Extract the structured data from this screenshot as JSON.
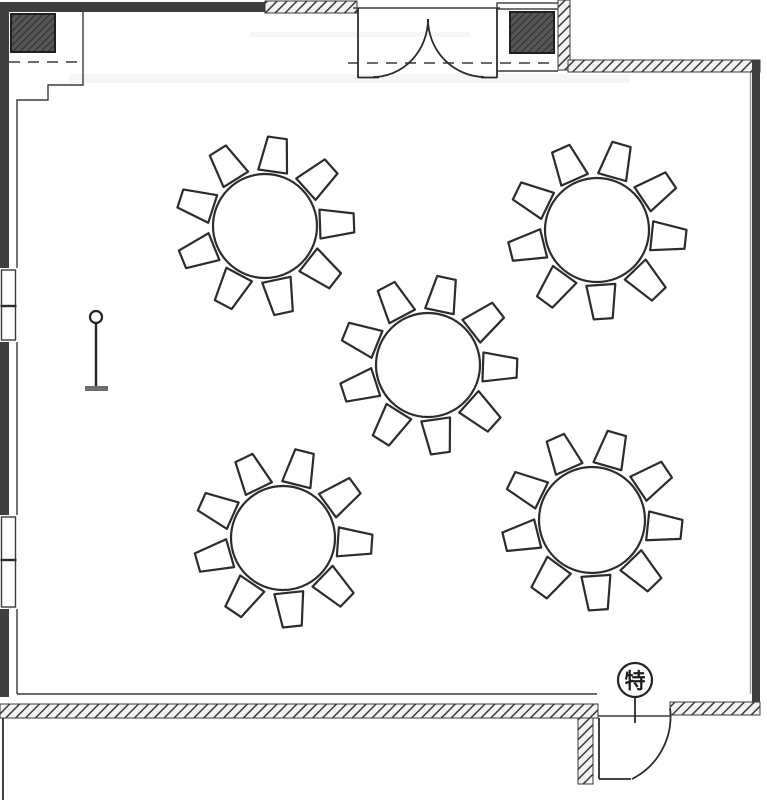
{
  "plan": {
    "type": "banquet-room-floor-plan",
    "colors": {
      "line": "#2c2c2c",
      "wall_fill": "#3e3e3e",
      "hatch_line": "#3a3a3a",
      "column_fill": "#565656",
      "stand_base": "#6e6e6e",
      "paper": "#ffffff"
    },
    "tag": {
      "label": "特"
    },
    "tables": [
      {
        "name": "banquet-table-1",
        "cx": 265,
        "cy": 226,
        "r": 52,
        "chairs": 9,
        "phase": 358
      },
      {
        "name": "banquet-table-2",
        "cx": 597,
        "cy": 230,
        "r": 52,
        "chairs": 9,
        "phase": 6
      },
      {
        "name": "banquet-table-3",
        "cx": 428,
        "cy": 365,
        "r": 52,
        "chairs": 9,
        "phase": 2
      },
      {
        "name": "banquet-table-4",
        "cx": 283,
        "cy": 538,
        "r": 52,
        "chairs": 9,
        "phase": 4
      },
      {
        "name": "banquet-table-5",
        "cx": 592,
        "cy": 520,
        "r": 53,
        "chairs": 9,
        "phase": 6
      }
    ],
    "chair": {
      "inner_gap": 3,
      "length": 34,
      "near_half": 14.5,
      "far_half": 9.5,
      "stroke": 2.2
    },
    "symbols": [
      {
        "name": "floor-stand-symbol",
        "x": 96,
        "y": 317
      },
      {
        "name": "special-door-tag",
        "x": 635,
        "y": 680
      }
    ],
    "doors": [
      {
        "name": "main-entrance-double-door",
        "wall": "top"
      },
      {
        "name": "service-door",
        "wall": "bottom-right"
      }
    ],
    "windows": [
      {
        "name": "window-upper",
        "y": 270,
        "h": 70
      },
      {
        "name": "window-lower",
        "y": 517,
        "h": 90
      }
    ],
    "columns": [
      {
        "name": "column-top-left"
      },
      {
        "name": "column-top-right"
      }
    ]
  }
}
